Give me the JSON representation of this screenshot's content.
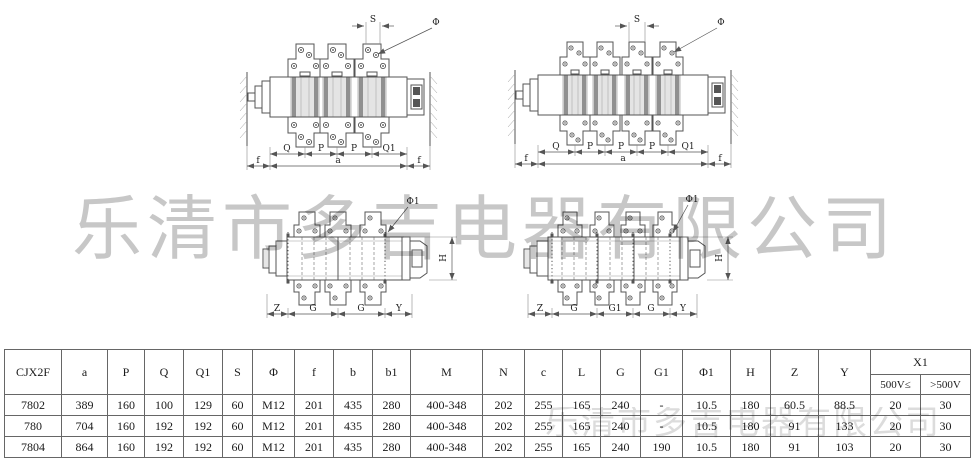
{
  "watermark": {
    "line1": "乐清市多吉电器有限公司",
    "line2": "乐清市多吉电器有限公司"
  },
  "drawings": {
    "front3": {
      "s": "S",
      "phi": "Φ",
      "q": "Q",
      "p1": "P",
      "p2": "P",
      "q1": "Q1",
      "f1": "f",
      "a": "a",
      "f2": "f"
    },
    "front4": {
      "s": "S",
      "phi": "Φ",
      "q": "Q",
      "p1": "P",
      "p2": "P",
      "p3": "P",
      "q1": "Q1",
      "f1": "f",
      "a": "a",
      "f2": "f"
    },
    "bottom3": {
      "phi1": "Φ1",
      "h": "H",
      "z": "Z",
      "g1": "G",
      "g2": "G",
      "y": "Y"
    },
    "bottom4": {
      "phi1": "Φ1",
      "h": "H",
      "z": "Z",
      "g1": "G",
      "gm": "G1",
      "g2": "G",
      "y": "Y"
    }
  },
  "table": {
    "headers": [
      "CJX2F",
      "a",
      "P",
      "Q",
      "Q1",
      "S",
      "Φ",
      "f",
      "b",
      "b1",
      "M",
      "N",
      "c",
      "L",
      "G",
      "G1",
      "Φ1",
      "H",
      "Z",
      "Y"
    ],
    "x1": {
      "label": "X1",
      "sub": [
        "500V≤",
        ">500V"
      ]
    },
    "rows": [
      [
        "7802",
        "389",
        "160",
        "100",
        "129",
        "60",
        "M12",
        "201",
        "435",
        "280",
        "400-348",
        "202",
        "255",
        "165",
        "240",
        "-",
        "10.5",
        "180",
        "60.5",
        "88.5",
        "20",
        "30"
      ],
      [
        "780",
        "704",
        "160",
        "192",
        "192",
        "60",
        "M12",
        "201",
        "435",
        "280",
        "400-348",
        "202",
        "255",
        "165",
        "240",
        "-",
        "10.5",
        "180",
        "91",
        "133",
        "20",
        "30"
      ],
      [
        "7804",
        "864",
        "160",
        "192",
        "192",
        "60",
        "M12",
        "201",
        "435",
        "280",
        "400-348",
        "202",
        "255",
        "165",
        "240",
        "190",
        "10.5",
        "180",
        "91",
        "103",
        "20",
        "30"
      ]
    ]
  }
}
